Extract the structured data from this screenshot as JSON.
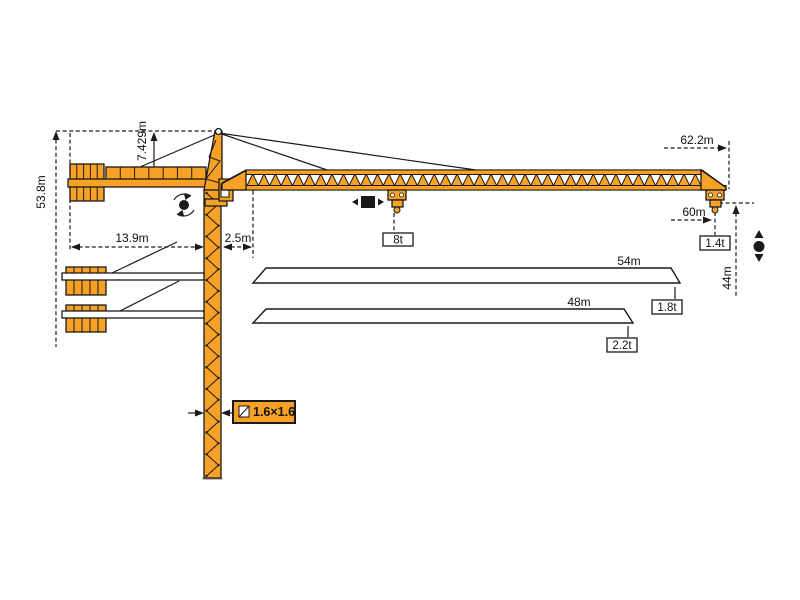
{
  "diagram": {
    "title": "tower-crane-working-range-diagram",
    "colors": {
      "crane": "#F7A127",
      "outline": "#1A1A1A",
      "background": "#FFFFFF"
    },
    "labels": {
      "total_height": "53.8m",
      "tower_head_height": "7.429m",
      "counter_jib_radius": "13.9m",
      "tower_to_jib_offset": "2.5m",
      "max_jib_radius": "62.2m",
      "radius_60": "60m",
      "hook_height": "44m",
      "load_mid_jib": "8t",
      "tip_load_60m": "1.4t",
      "mast_section": "1.6×1.6"
    },
    "jib_options": [
      {
        "length": "54m",
        "tip_load": "1.8t"
      },
      {
        "length": "48m",
        "tip_load": "2.2t"
      }
    ],
    "icons": {
      "slewing": "rotation-arrows-around-dot",
      "trolley_travel": "black-square-with-left-right-arrows",
      "hoisting": "black-dot-with-up-down-arrows",
      "mast_section": "small-square-with-diagonal"
    }
  }
}
